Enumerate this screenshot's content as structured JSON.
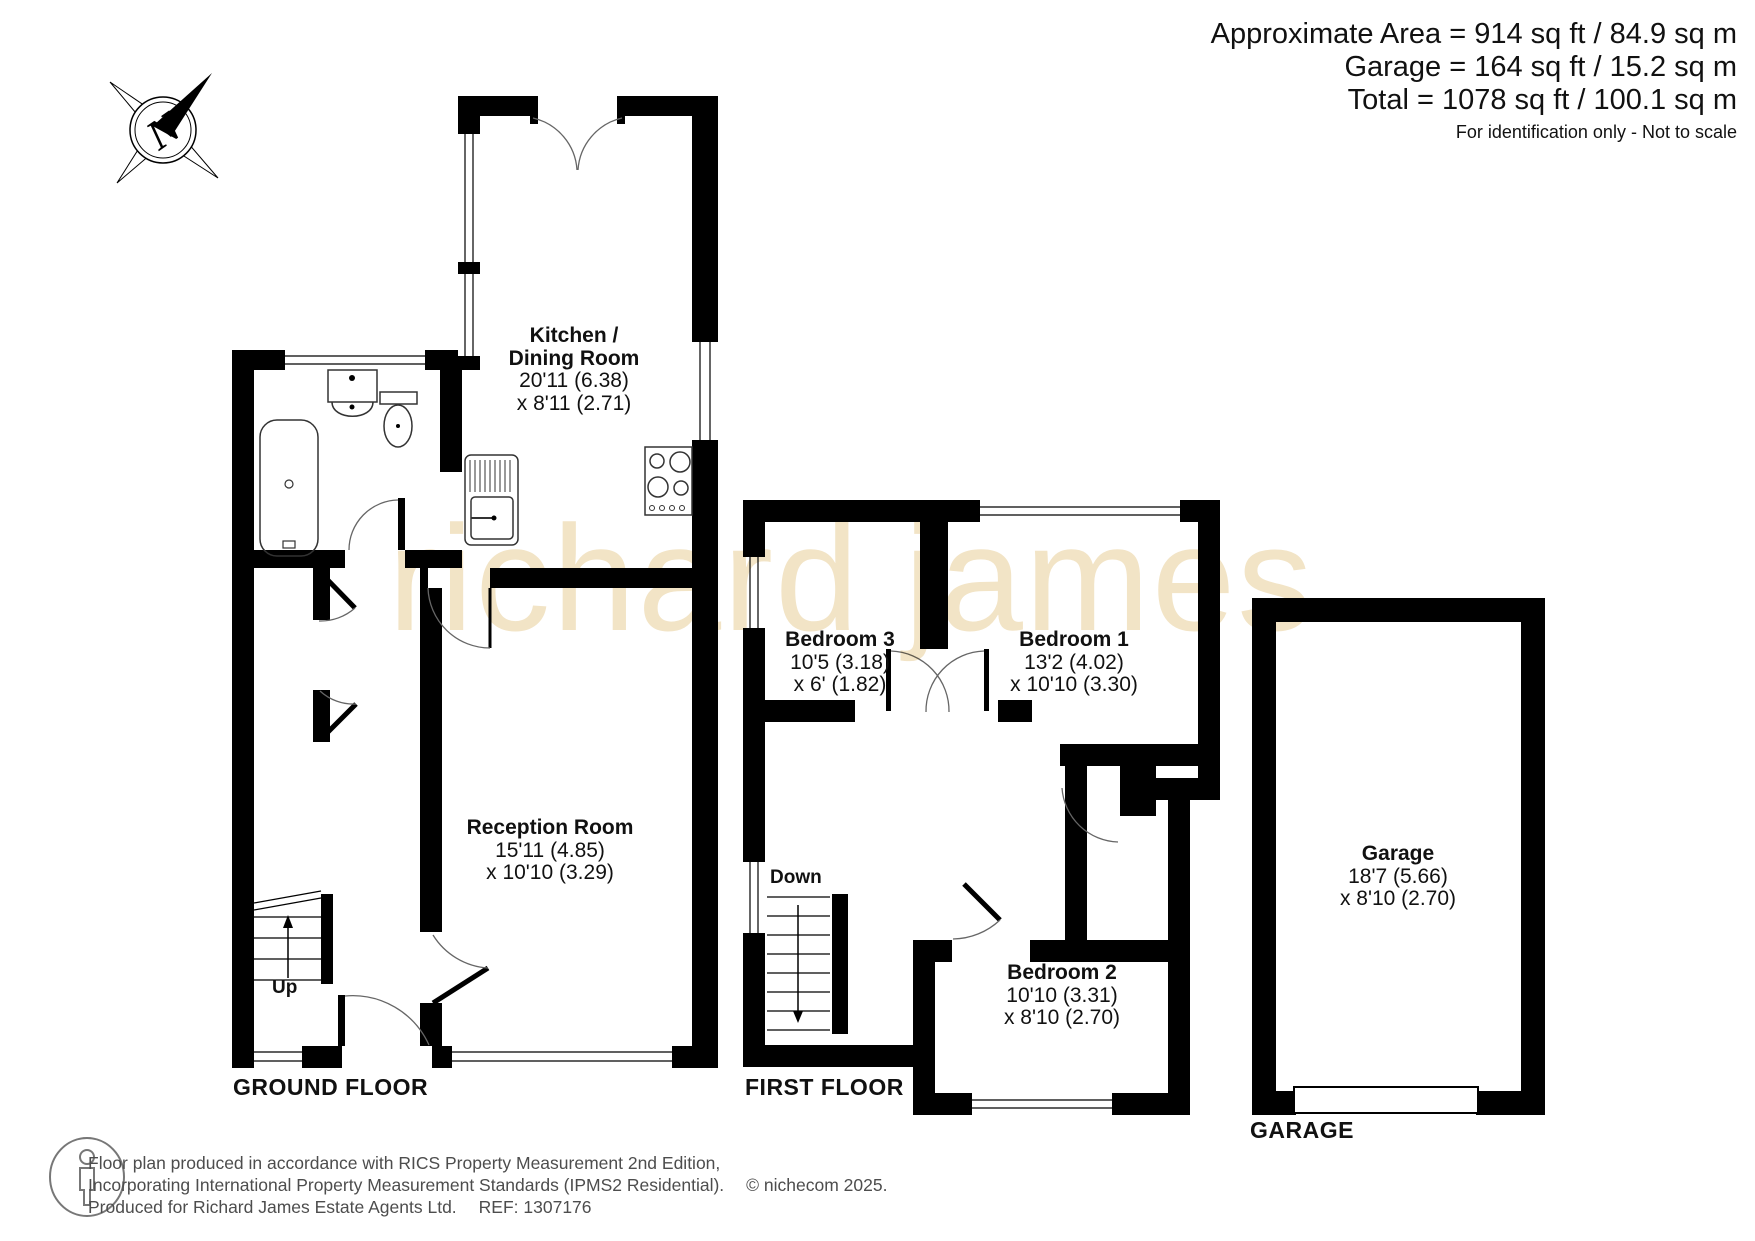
{
  "header": {
    "line1": "Approximate Area = 914 sq ft / 84.9 sq m",
    "line2": "Garage = 164 sq ft / 15.2 sq m",
    "line3": "Total = 1078 sq ft / 100.1 sq m",
    "note": "For identification only - Not to scale"
  },
  "compass": {
    "label": "N"
  },
  "watermark": {
    "text": "richard james",
    "color": "#f2e4c6"
  },
  "floors": {
    "ground": {
      "title": "GROUND FLOOR",
      "stairs_label": "Up",
      "kitchen": {
        "name_line1": "Kitchen /",
        "name_line2": "Dining Room",
        "dim1": "20'11 (6.38)",
        "dim2": "x 8'11 (2.71)"
      },
      "reception": {
        "name": "Reception Room",
        "dim1": "15'11 (4.85)",
        "dim2": "x 10'10 (3.29)"
      }
    },
    "first": {
      "title": "FIRST FLOOR",
      "stairs_label": "Down",
      "bedroom1": {
        "name": "Bedroom 1",
        "dim1": "13'2 (4.02)",
        "dim2": "x 10'10 (3.30)"
      },
      "bedroom2": {
        "name": "Bedroom 2",
        "dim1": "10'10 (3.31)",
        "dim2": "x 8'10 (2.70)"
      },
      "bedroom3": {
        "name": "Bedroom 3",
        "dim1": "10'5 (3.18)",
        "dim2": "x 6' (1.82)"
      }
    },
    "garage": {
      "title": "GARAGE",
      "room": {
        "name": "Garage",
        "dim1": "18'7 (5.66)",
        "dim2": "x 8'10 (2.70)"
      }
    }
  },
  "footer": {
    "line1": "Floor plan produced in accordance with RICS Property Measurement 2nd Edition,",
    "line2": "Incorporating International Property Measurement Standards (IPMS2 Residential).",
    "copyright": "© nichecom 2025.",
    "line3": "Produced for Richard James Estate Agents Ltd.",
    "ref": "REF: 1307176"
  }
}
